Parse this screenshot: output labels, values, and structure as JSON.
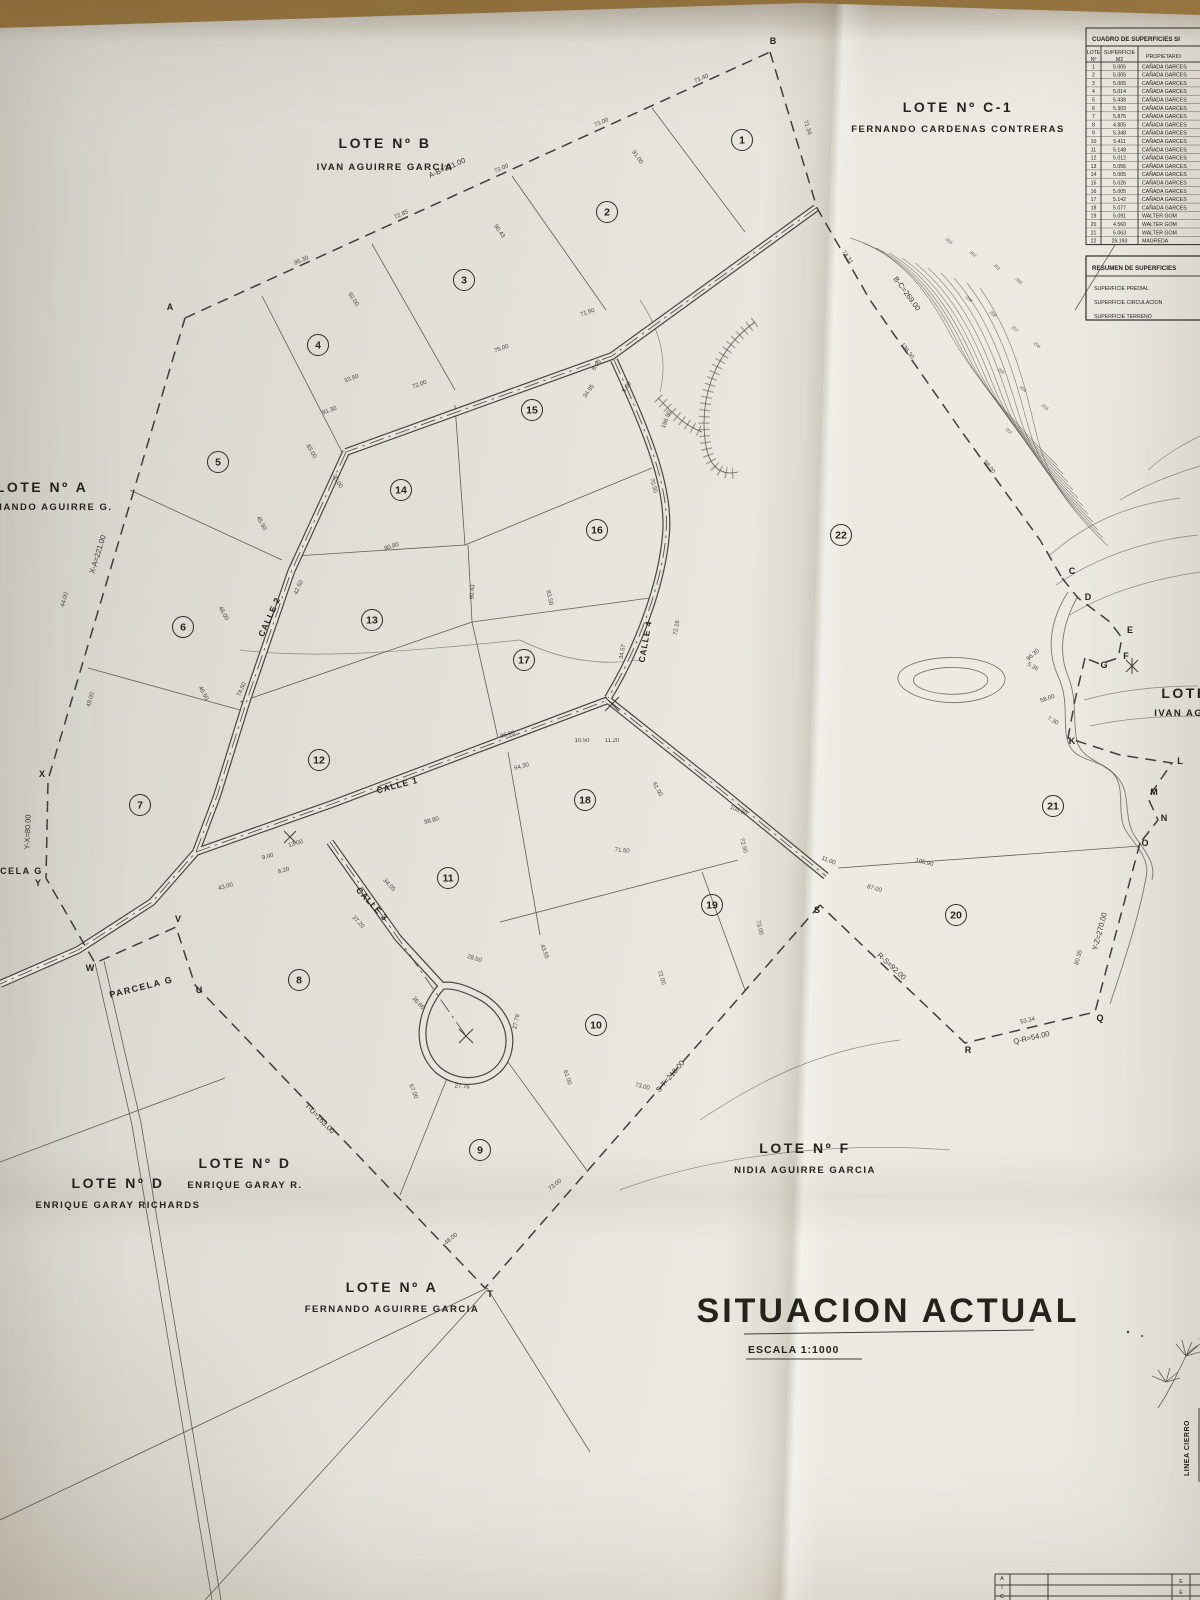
{
  "colors": {
    "desk": "#a8854c",
    "paper": "#e7e4dc",
    "ink": "#26231c",
    "line": "#4a463c"
  },
  "title": {
    "text": "SITUACION ACTUAL",
    "scale": "ESCALA 1:1000"
  },
  "legend": {
    "linea_cierro": "LINEA CIERRO"
  },
  "titleblock": {
    "col_left": "CIA",
    "col_right": "EE"
  },
  "lots": [
    {
      "name": "LOTE Nº B",
      "owner": "IVAN AGUIRRE GARCIA",
      "x": 385,
      "y": 148,
      "dy": 22
    },
    {
      "name": "LOTE Nº C-1",
      "owner": "FERNANDO CARDENAS CONTRERAS",
      "x": 958,
      "y": 112,
      "dy": 20
    },
    {
      "name": "LOTE Nº A",
      "owner": "FERNANDO AGUIRRE G.",
      "x": 42,
      "y": 492,
      "dy": 18
    },
    {
      "name": "LOTE Nº D",
      "owner": "ENRIQUE GARAY RICHARDS",
      "x": 118,
      "y": 1188,
      "dy": 20
    },
    {
      "name": "LOTE Nº D",
      "owner": "ENRIQUE GARAY R.",
      "x": 245,
      "y": 1168,
      "dy": 20
    },
    {
      "name": "LOTE Nº F",
      "owner": "NIDIA AGUIRRE GARCIA",
      "x": 805,
      "y": 1153,
      "dy": 20
    },
    {
      "name": "LOTE Nº A",
      "owner": "FERNANDO AGUIRRE GARCIA",
      "x": 392,
      "y": 1292,
      "dy": 20
    },
    {
      "name": "LOTE",
      "owner": "IVAN AGUI",
      "x": 1185,
      "y": 698,
      "dy": 18
    }
  ],
  "misc_labels": [
    {
      "t": "PARCELA  G",
      "x": 10,
      "y": 874,
      "r": 0
    },
    {
      "t": "PARCELA  G",
      "x": 142,
      "y": 990,
      "r": -14
    }
  ],
  "streets": [
    {
      "label": "CALLE 1",
      "x": 398,
      "y": 788,
      "r": -15
    },
    {
      "label": "CALLE 2",
      "x": 272,
      "y": 618,
      "r": -66
    },
    {
      "label": "CALLE 3",
      "x": 370,
      "y": 906,
      "r": 47
    },
    {
      "label": "CALLE 4",
      "x": 648,
      "y": 642,
      "r": -80
    }
  ],
  "parcels": [
    {
      "n": "1",
      "x": 742,
      "y": 140
    },
    {
      "n": "2",
      "x": 607,
      "y": 212
    },
    {
      "n": "3",
      "x": 464,
      "y": 280
    },
    {
      "n": "4",
      "x": 318,
      "y": 345
    },
    {
      "n": "5",
      "x": 218,
      "y": 462
    },
    {
      "n": "6",
      "x": 183,
      "y": 627
    },
    {
      "n": "7",
      "x": 140,
      "y": 805
    },
    {
      "n": "8",
      "x": 299,
      "y": 980
    },
    {
      "n": "9",
      "x": 480,
      "y": 1150
    },
    {
      "n": "10",
      "x": 596,
      "y": 1025
    },
    {
      "n": "11",
      "x": 448,
      "y": 878
    },
    {
      "n": "12",
      "x": 319,
      "y": 760
    },
    {
      "n": "13",
      "x": 372,
      "y": 620
    },
    {
      "n": "14",
      "x": 401,
      "y": 490
    },
    {
      "n": "15",
      "x": 532,
      "y": 410
    },
    {
      "n": "16",
      "x": 597,
      "y": 530
    },
    {
      "n": "17",
      "x": 524,
      "y": 660
    },
    {
      "n": "18",
      "x": 585,
      "y": 800
    },
    {
      "n": "19",
      "x": 712,
      "y": 905
    },
    {
      "n": "20",
      "x": 956,
      "y": 915
    },
    {
      "n": "21",
      "x": 1053,
      "y": 806
    },
    {
      "n": "22",
      "x": 841,
      "y": 535
    }
  ],
  "points": [
    {
      "l": "A",
      "x": 170,
      "y": 310
    },
    {
      "l": "B",
      "x": 773,
      "y": 44
    },
    {
      "l": "C",
      "x": 1072,
      "y": 574
    },
    {
      "l": "D",
      "x": 1088,
      "y": 600
    },
    {
      "l": "E",
      "x": 1130,
      "y": 633
    },
    {
      "l": "F",
      "x": 1126,
      "y": 659
    },
    {
      "l": "G",
      "x": 1104,
      "y": 668
    },
    {
      "l": "K",
      "x": 1072,
      "y": 744
    },
    {
      "l": "L",
      "x": 1180,
      "y": 764
    },
    {
      "l": "M",
      "x": 1154,
      "y": 795
    },
    {
      "l": "N",
      "x": 1164,
      "y": 821
    },
    {
      "l": "O",
      "x": 1145,
      "y": 846
    },
    {
      "l": "Q",
      "x": 1100,
      "y": 1021
    },
    {
      "l": "R",
      "x": 968,
      "y": 1053
    },
    {
      "l": "S",
      "x": 817,
      "y": 913
    },
    {
      "l": "T",
      "x": 490,
      "y": 1297
    },
    {
      "l": "U",
      "x": 199,
      "y": 993
    },
    {
      "l": "V",
      "x": 178,
      "y": 922
    },
    {
      "l": "W",
      "x": 90,
      "y": 971
    },
    {
      "l": "X",
      "x": 42,
      "y": 777
    },
    {
      "l": "Y",
      "x": 38,
      "y": 886
    }
  ],
  "big_dims": [
    {
      "t": "A-B=311.00",
      "x": 448,
      "y": 170,
      "r": -24
    },
    {
      "t": "B-C=269.00",
      "x": 905,
      "y": 295,
      "r": 54
    },
    {
      "t": "X-A=221.00",
      "x": 100,
      "y": 555,
      "r": -73
    },
    {
      "t": "Y-X=80.00",
      "x": 30,
      "y": 832,
      "r": -88
    },
    {
      "t": "T-U=163.00",
      "x": 318,
      "y": 1120,
      "r": 46
    },
    {
      "t": "S-T=218.00",
      "x": 672,
      "y": 1078,
      "r": -49
    },
    {
      "t": "R-S=92.00",
      "x": 890,
      "y": 968,
      "r": 43
    },
    {
      "t": "Q-R=54.00",
      "x": 1032,
      "y": 1040,
      "r": -13
    },
    {
      "t": "Y-Z=270.00",
      "x": 1102,
      "y": 932,
      "r": -75
    }
  ],
  "dims": [
    {
      "t": "95.30",
      "x": 302,
      "y": 262,
      "r": -24
    },
    {
      "t": "72.85",
      "x": 402,
      "y": 216,
      "r": -24
    },
    {
      "t": "73.00",
      "x": 502,
      "y": 170,
      "r": -24
    },
    {
      "t": "73.00",
      "x": 602,
      "y": 124,
      "r": -24
    },
    {
      "t": "73.40",
      "x": 702,
      "y": 80,
      "r": -24
    },
    {
      "t": "71.34",
      "x": 806,
      "y": 128,
      "r": 72
    },
    {
      "t": "74.31",
      "x": 846,
      "y": 258,
      "r": 55
    },
    {
      "t": "136.30",
      "x": 906,
      "y": 352,
      "r": 52
    },
    {
      "t": "98.00",
      "x": 988,
      "y": 468,
      "r": 50
    },
    {
      "t": "91.00",
      "x": 636,
      "y": 158,
      "r": 55
    },
    {
      "t": "90.43",
      "x": 498,
      "y": 232,
      "r": 55
    },
    {
      "t": "92.00",
      "x": 352,
      "y": 300,
      "r": 58
    },
    {
      "t": "72.00",
      "x": 420,
      "y": 386,
      "r": -20
    },
    {
      "t": "75.00",
      "x": 502,
      "y": 350,
      "r": -20
    },
    {
      "t": "71.50",
      "x": 588,
      "y": 314,
      "r": -20
    },
    {
      "t": "33.50",
      "x": 352,
      "y": 380,
      "r": -20
    },
    {
      "t": "8.00",
      "x": 598,
      "y": 366,
      "r": -55
    },
    {
      "t": "5.00",
      "x": 628,
      "y": 388,
      "r": -55
    },
    {
      "t": "34.95",
      "x": 590,
      "y": 392,
      "r": -55
    },
    {
      "t": "196.50",
      "x": 668,
      "y": 420,
      "r": -70
    },
    {
      "t": "83.00",
      "x": 310,
      "y": 452,
      "r": 60
    },
    {
      "t": "30.00",
      "x": 336,
      "y": 482,
      "r": 60
    },
    {
      "t": "91.30",
      "x": 330,
      "y": 412,
      "r": -20
    },
    {
      "t": "45.50",
      "x": 260,
      "y": 524,
      "r": 62
    },
    {
      "t": "48.00",
      "x": 222,
      "y": 614,
      "r": 62
    },
    {
      "t": "40.50",
      "x": 202,
      "y": 694,
      "r": 62
    },
    {
      "t": "49.00",
      "x": 92,
      "y": 700,
      "r": -74
    },
    {
      "t": "44.00",
      "x": 66,
      "y": 600,
      "r": -74
    },
    {
      "t": "42.50",
      "x": 300,
      "y": 588,
      "r": -66
    },
    {
      "t": "74.50",
      "x": 243,
      "y": 690,
      "r": -66
    },
    {
      "t": "90.80",
      "x": 392,
      "y": 548,
      "r": -17
    },
    {
      "t": "90.43",
      "x": 474,
      "y": 592,
      "r": -86
    },
    {
      "t": "83.50",
      "x": 548,
      "y": 598,
      "r": 78
    },
    {
      "t": "70.50",
      "x": 652,
      "y": 486,
      "r": 74
    },
    {
      "t": "86.00",
      "x": 508,
      "y": 736,
      "r": -15
    },
    {
      "t": "64.30",
      "x": 522,
      "y": 768,
      "r": -15
    },
    {
      "t": "10.50",
      "x": 582,
      "y": 742,
      "r": 0
    },
    {
      "t": "11.20",
      "x": 612,
      "y": 742,
      "r": 0
    },
    {
      "t": "98.80",
      "x": 432,
      "y": 822,
      "r": -15
    },
    {
      "t": "13.00",
      "x": 296,
      "y": 845,
      "r": -15
    },
    {
      "t": "9.00",
      "x": 268,
      "y": 858,
      "r": -15
    },
    {
      "t": "8.20",
      "x": 284,
      "y": 872,
      "r": -15
    },
    {
      "t": "43.00",
      "x": 226,
      "y": 888,
      "r": -15
    },
    {
      "t": "34.05",
      "x": 388,
      "y": 886,
      "r": 47
    },
    {
      "t": "37.20",
      "x": 357,
      "y": 923,
      "r": 47
    },
    {
      "t": "36.66",
      "x": 417,
      "y": 1004,
      "r": 47
    },
    {
      "t": "28.50",
      "x": 474,
      "y": 960,
      "r": 18
    },
    {
      "t": "27.79",
      "x": 518,
      "y": 1022,
      "r": -78
    },
    {
      "t": "27.76",
      "x": 462,
      "y": 1088,
      "r": 4
    },
    {
      "t": "34.57",
      "x": 624,
      "y": 652,
      "r": -80
    },
    {
      "t": "72.16",
      "x": 678,
      "y": 628,
      "r": -80
    },
    {
      "t": "71.50",
      "x": 622,
      "y": 852,
      "r": 6
    },
    {
      "t": "61.00",
      "x": 656,
      "y": 790,
      "r": 62
    },
    {
      "t": "72.50",
      "x": 742,
      "y": 846,
      "r": 74
    },
    {
      "t": "73.00",
      "x": 758,
      "y": 928,
      "r": 76
    },
    {
      "t": "103.00",
      "x": 738,
      "y": 812,
      "r": 22
    },
    {
      "t": "11.00",
      "x": 828,
      "y": 862,
      "r": 22
    },
    {
      "t": "87.00",
      "x": 874,
      "y": 890,
      "r": 16
    },
    {
      "t": "105.90",
      "x": 924,
      "y": 864,
      "r": 14
    },
    {
      "t": "61.00",
      "x": 566,
      "y": 1078,
      "r": 72
    },
    {
      "t": "67.00",
      "x": 412,
      "y": 1092,
      "r": 68
    },
    {
      "t": "73.00",
      "x": 642,
      "y": 1088,
      "r": 14
    },
    {
      "t": "72.00",
      "x": 660,
      "y": 978,
      "r": 72
    },
    {
      "t": "43.55",
      "x": 543,
      "y": 952,
      "r": 70
    },
    {
      "t": "73.00",
      "x": 556,
      "y": 1186,
      "r": -40
    },
    {
      "t": "48.00",
      "x": 452,
      "y": 1240,
      "r": -40
    },
    {
      "t": "96.30",
      "x": 1034,
      "y": 656,
      "r": -42
    },
    {
      "t": "58.00",
      "x": 1048,
      "y": 700,
      "r": -20
    },
    {
      "t": "80.35",
      "x": 1080,
      "y": 958,
      "r": -74
    },
    {
      "t": "53.34",
      "x": 1028,
      "y": 1022,
      "r": -13
    },
    {
      "t": "7.30",
      "x": 1052,
      "y": 722,
      "r": 30
    },
    {
      "t": "5.36",
      "x": 1032,
      "y": 668,
      "r": 30
    }
  ],
  "contour_labels": [
    {
      "t": "263",
      "x": 948,
      "y": 242
    },
    {
      "t": "262",
      "x": 972,
      "y": 255
    },
    {
      "t": "261",
      "x": 996,
      "y": 268
    },
    {
      "t": "260",
      "x": 1018,
      "y": 282
    },
    {
      "t": "259",
      "x": 968,
      "y": 300
    },
    {
      "t": "258",
      "x": 992,
      "y": 315
    },
    {
      "t": "257",
      "x": 1014,
      "y": 330
    },
    {
      "t": "256",
      "x": 1036,
      "y": 346
    },
    {
      "t": "255",
      "x": 1000,
      "y": 372
    },
    {
      "t": "254",
      "x": 1022,
      "y": 390
    },
    {
      "t": "253",
      "x": 1044,
      "y": 408
    },
    {
      "t": "252",
      "x": 1008,
      "y": 432
    }
  ],
  "table": {
    "title": "CUADRO DE SUPERFICIES SI",
    "col1a": "LOTE",
    "col1b": "Nº",
    "col2a": "SUPERFICIE",
    "col2b": "M2",
    "col3": "PROPIETARIO",
    "rows": [
      [
        "1",
        "5.005",
        "CAÑADA GARCES"
      ],
      [
        "2",
        "5.005",
        "CAÑADA GARCES"
      ],
      [
        "3",
        "5.005",
        "CAÑADA GARCES"
      ],
      [
        "4",
        "5.014",
        "CAÑADA GARCES"
      ],
      [
        "5",
        "5.438",
        "CAÑADA GARCES"
      ],
      [
        "6",
        "5.303",
        "CAÑADA GARCES"
      ],
      [
        "7",
        "5.875",
        "CAÑADA GARCES"
      ],
      [
        "8",
        "4.805",
        "CAÑADA GARCES"
      ],
      [
        "9",
        "5.348",
        "CAÑADA GARCES"
      ],
      [
        "10",
        "5.411",
        "CAÑADA GARCES"
      ],
      [
        "11",
        "5.148",
        "CAÑADA GARCES"
      ],
      [
        "12",
        "5.012",
        "CAÑADA GARCES"
      ],
      [
        "13",
        "5.056",
        "CAÑADA GARCES"
      ],
      [
        "14",
        "5.005",
        "CAÑADA GARCES"
      ],
      [
        "15",
        "5.026",
        "CAÑADA GARCES"
      ],
      [
        "16",
        "5.005",
        "CAÑADA GARCES"
      ],
      [
        "17",
        "5.142",
        "CAÑADA GARCES"
      ],
      [
        "18",
        "5.077",
        "CAÑADA GARCES"
      ],
      [
        "19",
        "5.091",
        "WALTER GOM"
      ],
      [
        "20",
        "4.560",
        "WALTER GOM"
      ],
      [
        "21",
        "5.063",
        "WALTER GOM"
      ],
      [
        "22",
        "26.193",
        "MAGREDA"
      ]
    ]
  },
  "resumen": {
    "title": "RESUMEN DE SUPERFICIES",
    "items": [
      "SUPERFICIE PREDIAL",
      "SUPERFICIE CIRCULACION",
      "SUPERFICIE TERRENO"
    ]
  }
}
